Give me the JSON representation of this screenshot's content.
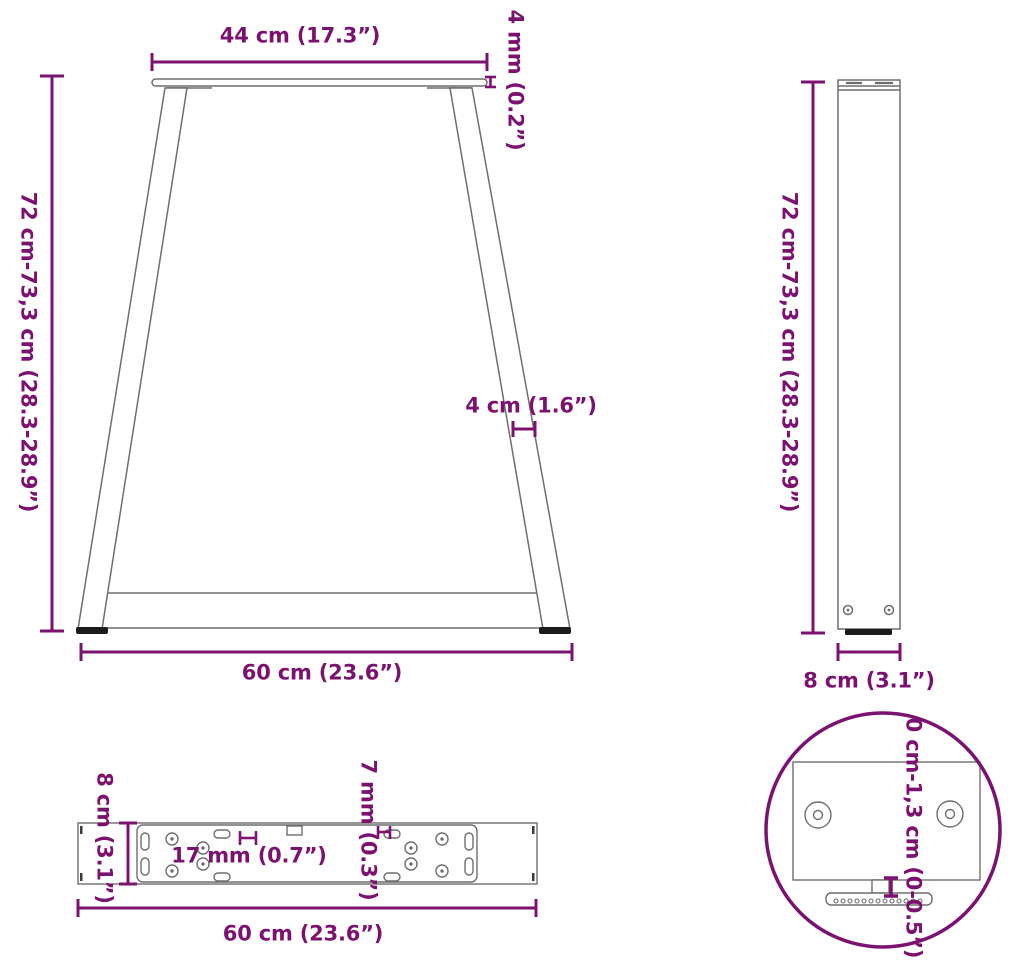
{
  "accent_color": "#7C1270",
  "structure_color": "#6E6E6E",
  "foot_color": "#1B1B1B",
  "views": {
    "front": {
      "top_width_label": "44 cm (17.3”)",
      "plate_thickness_label": "4 mm (0.2”)",
      "height_label": "72 cm-73,3 cm (28.3-28.9”)",
      "leg_width_label": "4 cm (1.6”)",
      "bottom_width_label": "60 cm (23.6”)"
    },
    "side": {
      "height_label": "72 cm-73,3 cm (28.3-28.9”)",
      "depth_label": "8 cm (3.1”)"
    },
    "top": {
      "depth_label": "8 cm (3.1”)",
      "large_hole_label": "17 mm (0.7”)",
      "small_hole_label": "7 mm (0.3”)",
      "length_label": "60 cm (23.6”)"
    },
    "detail": {
      "height_adjustment_label": "0 cm-1,3 cm (0-0.5”)"
    }
  }
}
